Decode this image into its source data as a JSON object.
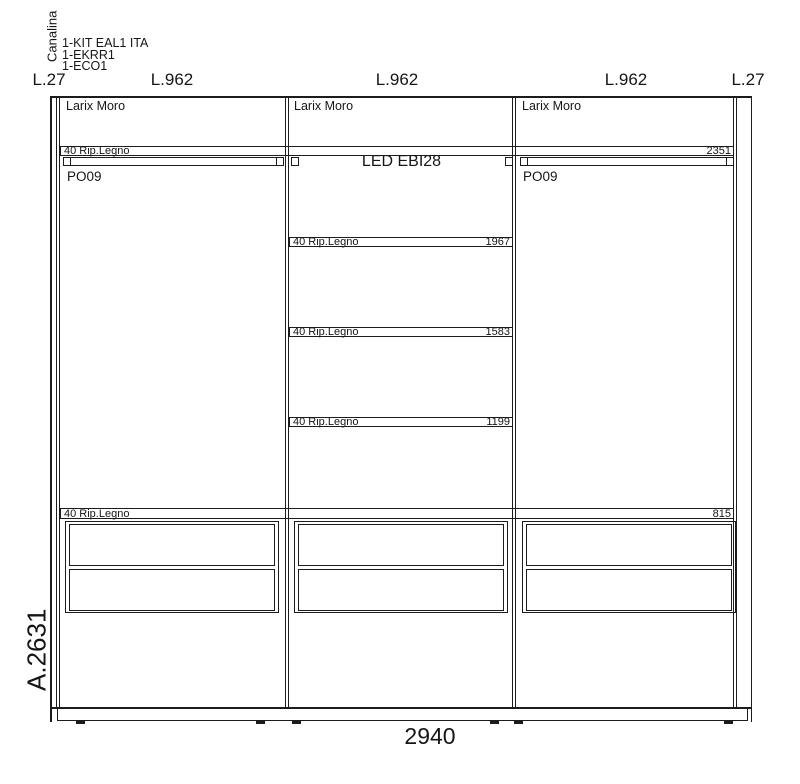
{
  "header": {
    "vertical_label": "Canalina",
    "kit_lines": [
      "1-KIT EAL1 ITA",
      "1-EKRR1",
      "1-ECO1"
    ]
  },
  "top_dimensions": [
    "L.27",
    "L.962",
    "L.962",
    "L.962",
    "L.27"
  ],
  "cabinet": {
    "sections": [
      {
        "material": "Larix Moro",
        "door": "PO09"
      },
      {
        "material": "Larix Moro",
        "led": "LED EBI28"
      },
      {
        "material": "Larix Moro",
        "door": "PO09"
      }
    ],
    "shelves": [
      {
        "label": "40 Rip.Legno",
        "height": "2351"
      },
      {
        "label": "40 Rip.Legno",
        "height": "1967"
      },
      {
        "label": "40 Rip.Legno",
        "height": "1583"
      },
      {
        "label": "40 Rip.Legno",
        "height": "1199"
      },
      {
        "label": "40 Rip.Legno",
        "height": "815"
      }
    ]
  },
  "overall": {
    "height_label": "A.2631",
    "width_label": "2940"
  },
  "colors": {
    "line": "#1c1c1c",
    "background": "#ffffff"
  }
}
